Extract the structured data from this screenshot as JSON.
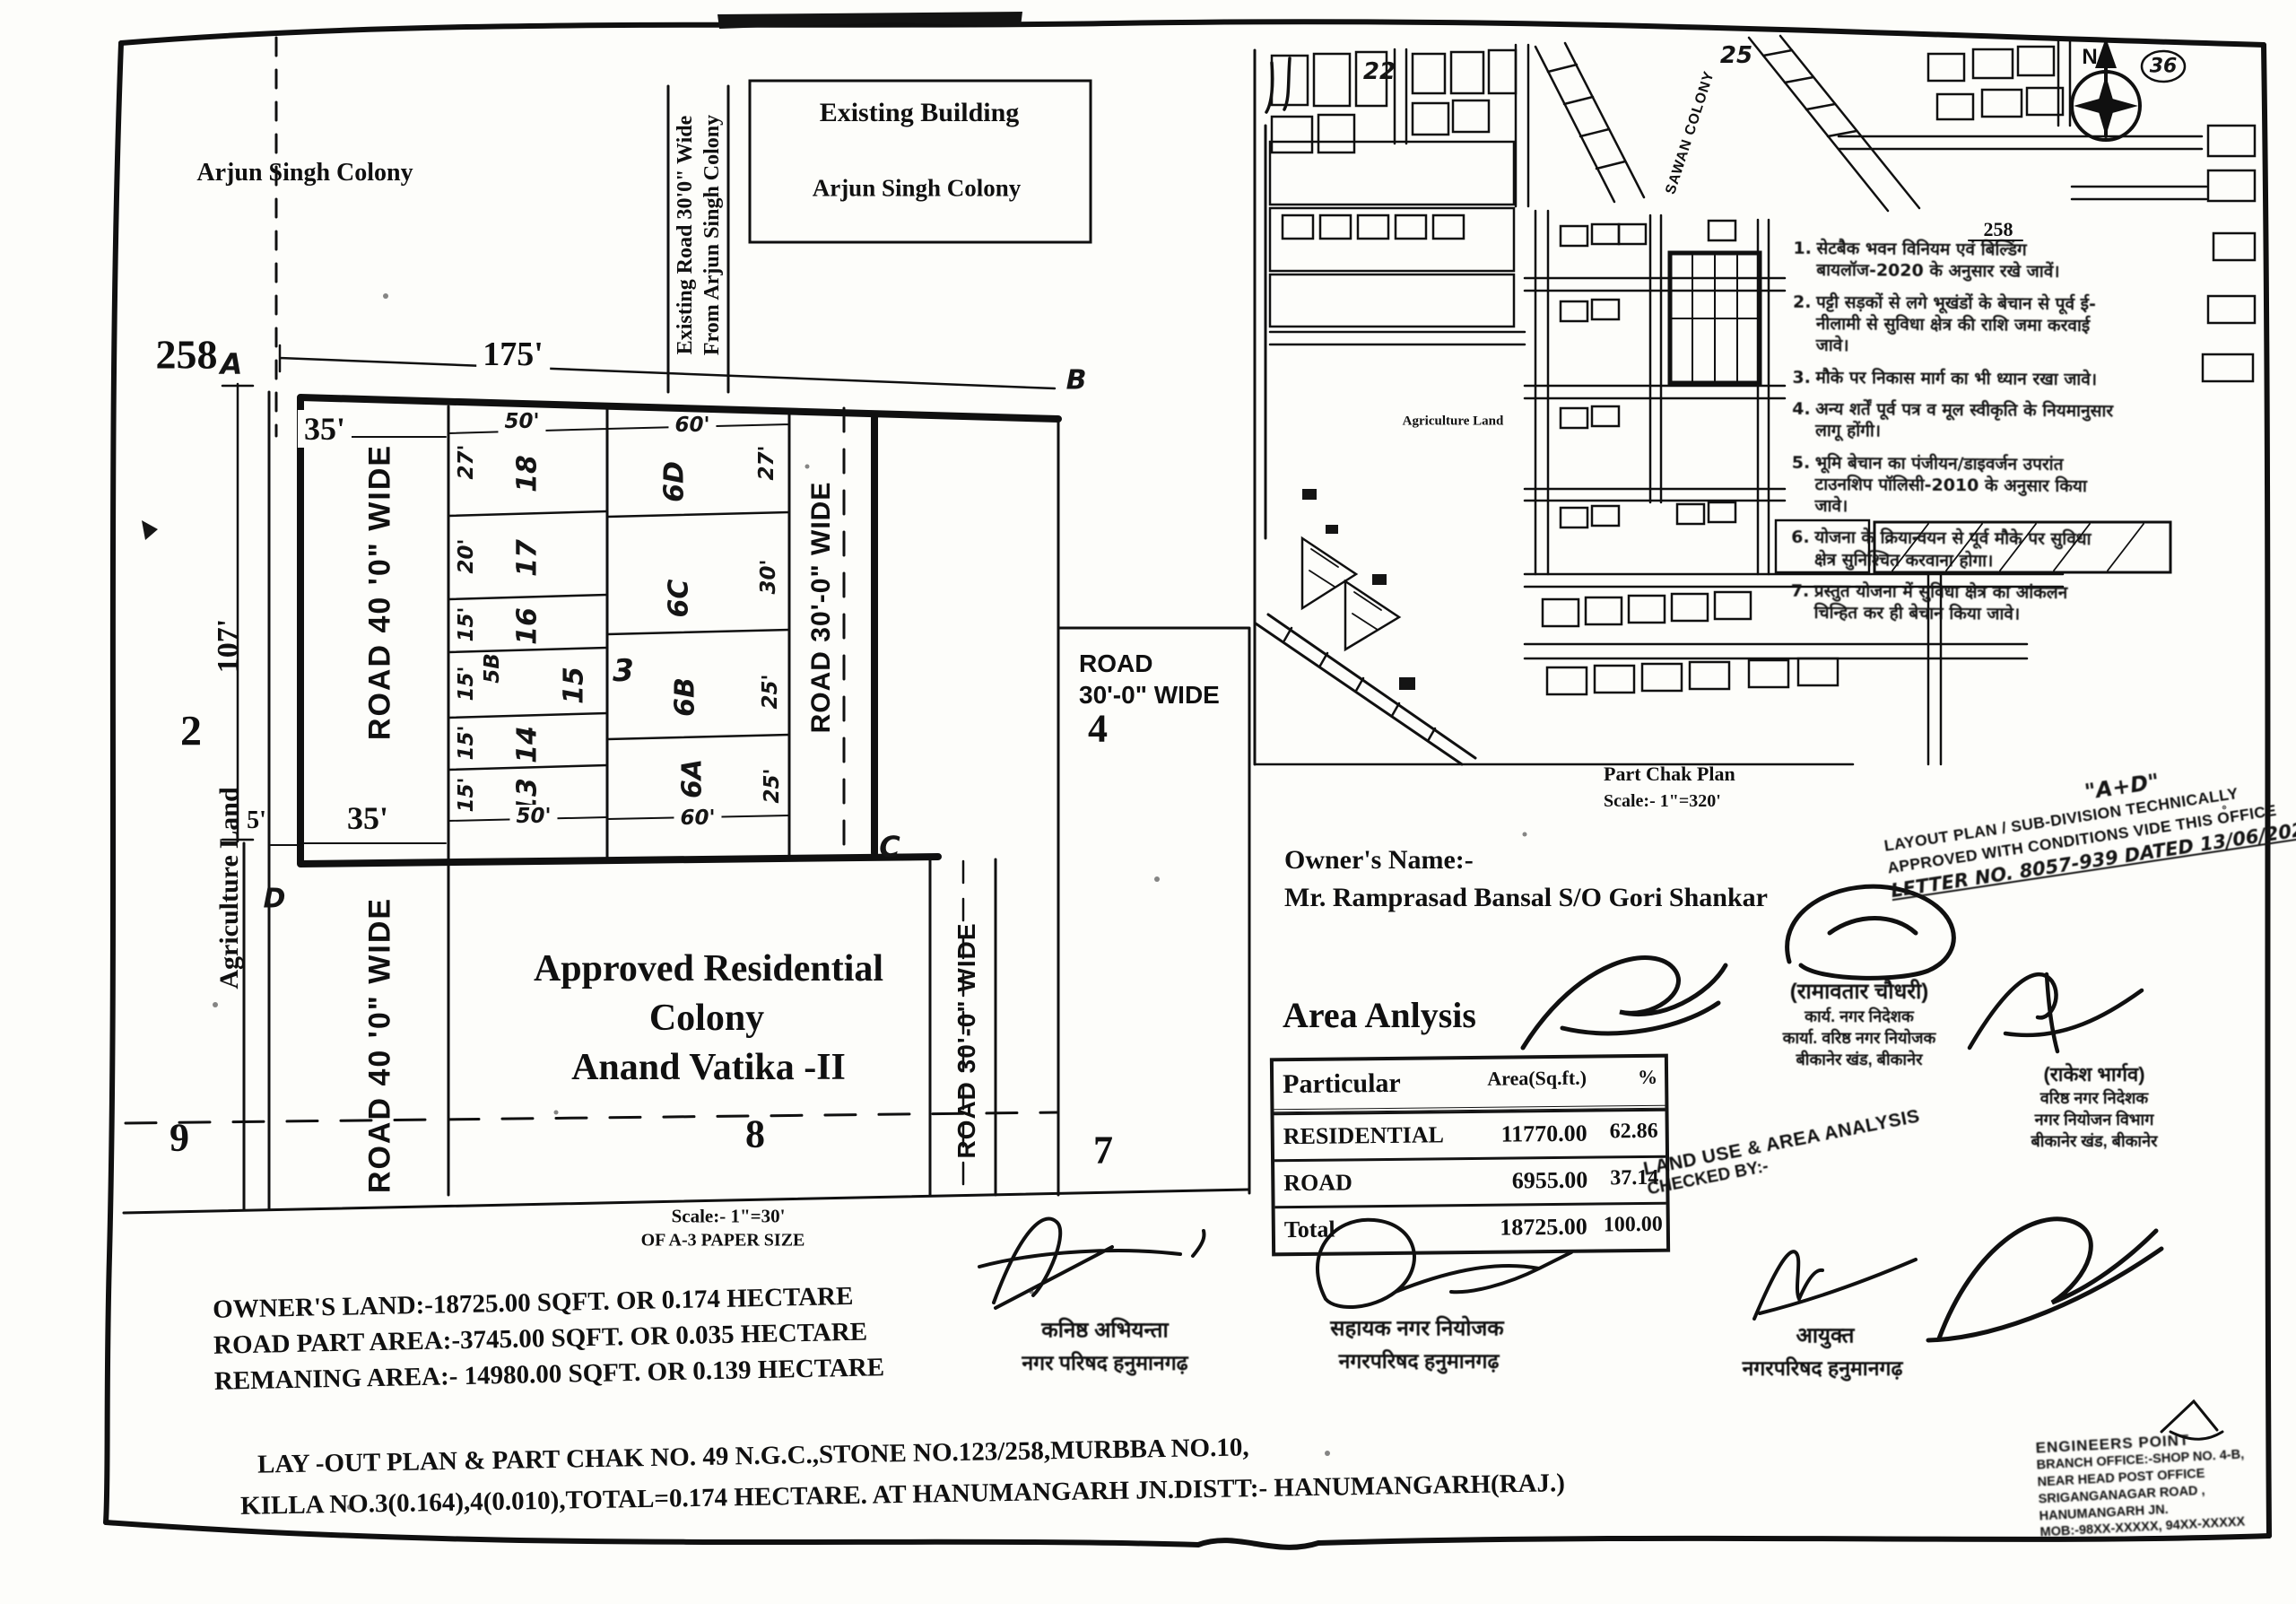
{
  "plan": {
    "labels": {
      "arjun_singh_colony": "Arjun Singh Colony",
      "existing_building_l1": "Existing Building",
      "existing_building_l2": "Arjun Singh Colony",
      "existing_road_l1": "Existing Road 30'0\" Wide",
      "existing_road_l2": "From Arjun Singh Colony",
      "stone_no": "258",
      "corner_a": "A",
      "corner_b": "B",
      "corner_c": "C",
      "corner_d": "D",
      "dim_175": "175'",
      "dim_35_top": "35'",
      "dim_35_bottom": "35'",
      "dim_107": "107'",
      "dim_5": "5'",
      "plot_2": "2",
      "plot_4": "4",
      "plot_7": "7",
      "plot_8": "8",
      "plot_9": "9",
      "agriculture_land": "Agriculture Land",
      "road_40": "ROAD 40 '0\" WIDE",
      "road_30_vertical": "ROAD 30'-0\" WIDE",
      "road_30_box_l1": "ROAD",
      "road_30_box_l2": "30'-0\" WIDE",
      "colony_l1": "Approved Residential",
      "colony_l2": "Colony",
      "colony_l3": "Anand Vatika -II",
      "scale_l1": "Scale:- 1\"=30'",
      "scale_l2": "OF A-3 PAPER SIZE"
    },
    "grid": {
      "left_plots": [
        {
          "no": "18",
          "dim": "27'"
        },
        {
          "no": "17",
          "dim": "20'"
        },
        {
          "no": "16",
          "dim": "15'"
        },
        {
          "no": "15",
          "dim": "15'"
        },
        {
          "no": "14",
          "dim": "15'"
        },
        {
          "no": "13",
          "dim": "15'"
        }
      ],
      "left_extra": "5B",
      "block_no": "3",
      "right_plots": [
        {
          "no": "6D",
          "dim": "27'"
        },
        {
          "no": "6C",
          "dim": "30'"
        },
        {
          "no": "6B",
          "dim": "25'"
        },
        {
          "no": "6A",
          "dim": "25'"
        }
      ],
      "top_dims": [
        "50'",
        "60'"
      ],
      "bottom_dims": [
        "50'",
        "60'"
      ]
    },
    "notes": {
      "owner_land": "OWNER'S LAND:-18725.00 SQFT. OR 0.174 HECTARE",
      "road_part": "ROAD PART AREA:-3745.00 SQFT. OR 0.035 HECTARE",
      "remaining": "REMANING AREA:- 14980.00 SQFT. OR 0.139 HECTARE",
      "layout_l1": "LAY -OUT PLAN & PART CHAK NO. 49 N.G.C.,STONE NO.123/258,MURBBA NO.10,",
      "layout_l2": "KILLA NO.3(0.164),4(0.010),TOTAL=0.174 HECTARE. AT HANUMANGARH JN.DISTT:- HANUMANGARH(RAJ.)"
    }
  },
  "map": {
    "title": "Part Chak Plan",
    "scale": "Scale:- 1\"=320'",
    "sawan_colony": "SAWAN COLONY",
    "stone_258": "258",
    "agriculture_land": "Agriculture Land",
    "n22": "22",
    "n25": "25",
    "circled_note": "36",
    "north": "N"
  },
  "hindi_notes": [
    {
      "n": "1.",
      "t": "सेटबैक भवन विनियम एवं बिल्डिंग बायलॉज-2020 के अनुसार रखे जावें।"
    },
    {
      "n": "2.",
      "t": "पट्टी सड़कों से लगे भूखंडों के बेचान से पूर्व ई-नीलामी से सुविधा क्षेत्र की राशि जमा करवाई जावे।"
    },
    {
      "n": "3.",
      "t": "मौके पर निकास मार्ग का भी ध्यान रखा जावे।"
    },
    {
      "n": "4.",
      "t": "अन्य शर्तें पूर्व पत्र व मूल स्वीकृति के नियमानुसार लागू होंगी।"
    },
    {
      "n": "5.",
      "t": "भूमि बेचान का पंजीयन/डाइवर्जन उपरांत टाउनशिप पॉलिसी-2010 के अनुसार किया जावे।"
    },
    {
      "n": "6.",
      "t": "योजना के क्रियान्वयन से पूर्व मौके पर सुविधा क्षेत्र सुनिश्चित करवाना होगा।"
    },
    {
      "n": "7.",
      "t": "प्रस्तुत योजना में सुविधा क्षेत्र का आंकलन चिन्हित कर ही बेचान किया जावे।"
    }
  ],
  "approval_stamp": {
    "tag": "\"A+D\"",
    "l1": "LAYOUT PLAN / SUB-DIVISION TECHNICALLY",
    "l2": "APPROVED WITH CONDITIONS VIDE THIS OFFICE",
    "l3": "LETTER NO. 8057-939 DATED 13/06/2024"
  },
  "owner": {
    "heading": "Owner's Name:-",
    "name": "Mr. Ramprasad Bansal S/O Gori Shankar"
  },
  "area_table": {
    "heading": "Area Anlysis",
    "headers": [
      "Particular",
      "Area(Sq.ft.)",
      "%"
    ],
    "rows": [
      [
        "RESIDENTIAL",
        "11770.00",
        "62.86"
      ],
      [
        "ROAD",
        "6955.00",
        "37.14"
      ],
      [
        "Total",
        "18725.00",
        "100.00"
      ]
    ]
  },
  "checked_stamp": {
    "l1": "LAND USE & AREA ANALYSIS",
    "l2": "CHECKED BY:-"
  },
  "officials": [
    {
      "title": "कनिष्ठ अभियन्ता",
      "org": "नगर परिषद हनुमानगढ़"
    },
    {
      "title": "सहायक नगर नियोजक",
      "org": "नगरपरिषद हनुमानगढ़"
    },
    {
      "title": "आयुक्त",
      "org": "नगरपरिषद हनुमानगढ़"
    }
  ],
  "regional_stamps": [
    {
      "name": "(रामावतार चौधरी)",
      "l1": "कार्य. नगर निदेशक",
      "l2": "कार्या. वरिष्ठ नगर नियोजक",
      "l3": "बीकानेर खंड, बीकानेर"
    },
    {
      "name": "(राकेश भार्गव)",
      "l1": "वरिष्ठ नगर निदेशक",
      "l2": "नगर नियोजन विभाग",
      "l3": "बीकानेर खंड, बीकानेर"
    }
  ],
  "agency_stamp": {
    "name": "ENGINEERS POINT",
    "l1": "BRANCH OFFICE:-SHOP NO. 4-B,",
    "l2": "NEAR HEAD POST OFFICE",
    "l3": "SRIGANGANAGAR ROAD ,",
    "l4": "HANUMANGARH JN.",
    "l5": "MOB:-98XX-XXXXX, 94XX-XXXXX"
  }
}
